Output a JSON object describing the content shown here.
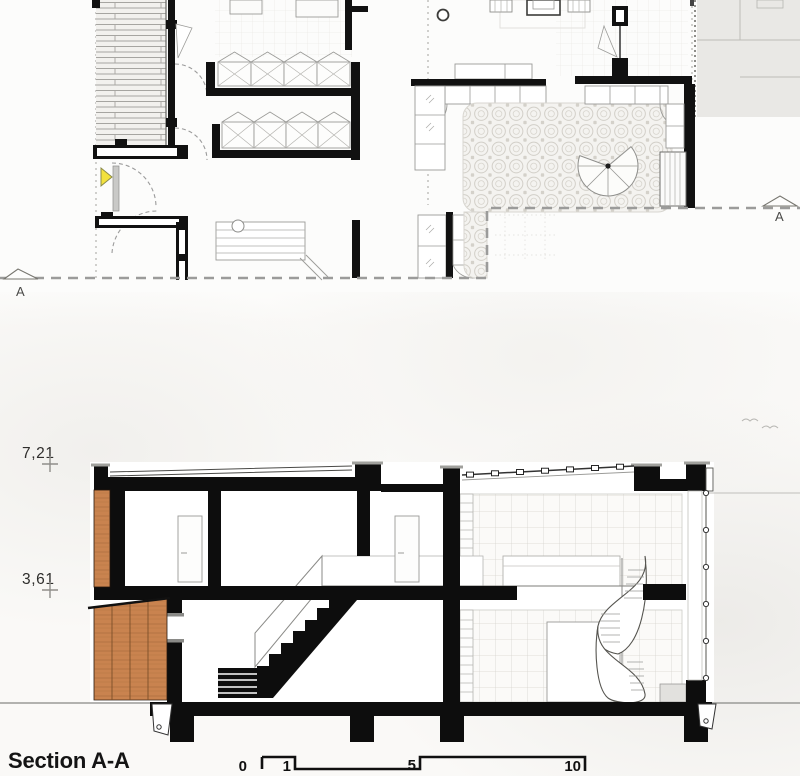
{
  "plan": {
    "cut_marker_left": "A",
    "cut_marker_right": "A"
  },
  "section": {
    "title": "Section A-A",
    "level_upper": "7,21",
    "level_lower": "3,61"
  },
  "scale_bar": {
    "ticks": [
      "0",
      "1",
      "5",
      "10"
    ]
  },
  "colors": {
    "ink": "#111111",
    "wood": "#c9834f",
    "wood_dark": "#9a6336",
    "entry_yellow": "#f2e13d",
    "adjacent_gray": "#e9e8e5",
    "paper": "#fbfaf8"
  }
}
